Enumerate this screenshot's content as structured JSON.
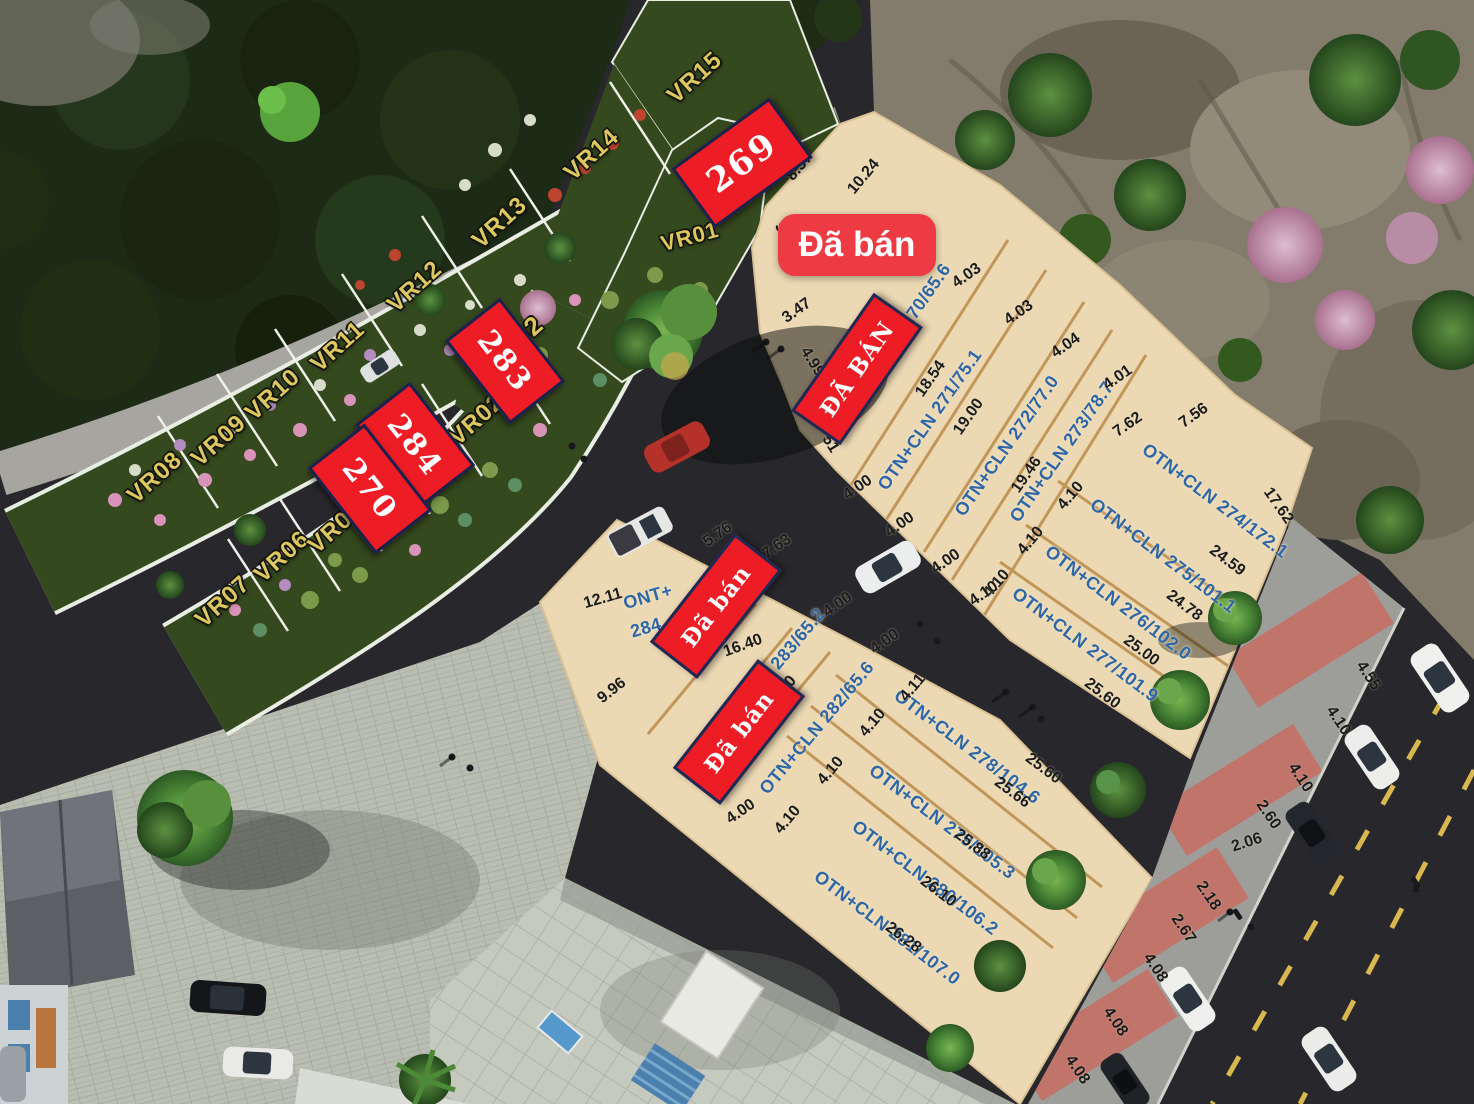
{
  "colors": {
    "plot_fill": "#ecd9b4",
    "plot_divider": "#c09659",
    "sold_red": "#ed1c25",
    "badge_red": "#ee3a43",
    "label_blue": "#2e66a6",
    "dim_black": "#1b1b1b",
    "vr_yellow": "#ddc75f",
    "garden_green": "#35491f",
    "road_asphalt": "#28282c"
  },
  "sold_overlays": [
    {
      "kind": "badge",
      "text": "Đã bán",
      "x": 857,
      "y": 245,
      "w": 158,
      "h": 62,
      "rot": 0
    },
    {
      "kind": "plate",
      "text": "ĐÃ BÁN",
      "x": 857,
      "y": 369,
      "w": 138,
      "h": 54,
      "rot": -55
    },
    {
      "kind": "plate",
      "text": "Đã bán",
      "x": 716,
      "y": 606,
      "w": 132,
      "h": 54,
      "rot": -52
    },
    {
      "kind": "plate",
      "text": "Đã bán",
      "x": 739,
      "y": 732,
      "w": 132,
      "h": 54,
      "rot": -52
    }
  ],
  "lot_number_overlays": [
    {
      "text": "269",
      "x": 742,
      "y": 163,
      "w": 115,
      "h": 68,
      "rot": -36,
      "size": 34
    },
    {
      "text": "283",
      "x": 505,
      "y": 361,
      "w": 100,
      "h": 64,
      "rot": 52,
      "size": 30
    },
    {
      "text": "284",
      "x": 415,
      "y": 445,
      "w": 100,
      "h": 64,
      "rot": 52,
      "size": 30
    },
    {
      "text": "270",
      "x": 370,
      "y": 489,
      "w": 104,
      "h": 66,
      "rot": 52,
      "size": 30
    }
  ],
  "vr_labels": [
    {
      "text": "VR15",
      "x": 695,
      "y": 78,
      "rot": -42
    },
    {
      "text": "VR14",
      "x": 592,
      "y": 155,
      "rot": -42
    },
    {
      "text": "VR13",
      "x": 500,
      "y": 223,
      "rot": -42
    },
    {
      "text": "VR12",
      "x": 415,
      "y": 287,
      "rot": -42
    },
    {
      "text": "VR11",
      "x": 338,
      "y": 347,
      "rot": -42
    },
    {
      "text": "VR10",
      "x": 273,
      "y": 395,
      "rot": -42
    },
    {
      "text": "VR09",
      "x": 219,
      "y": 441,
      "rot": -42
    },
    {
      "text": "VR08",
      "x": 155,
      "y": 478,
      "rot": -42
    },
    {
      "text": "VR07",
      "x": 223,
      "y": 602,
      "rot": -42
    },
    {
      "text": "VR06",
      "x": 282,
      "y": 557,
      "rot": -42
    },
    {
      "text": "VR05",
      "x": 336,
      "y": 528,
      "rot": -42
    },
    {
      "text": "VR02",
      "x": 477,
      "y": 420,
      "rot": -42
    },
    {
      "text": "02",
      "x": 528,
      "y": 331,
      "rot": -42,
      "size": 26
    },
    {
      "text": "VR01",
      "x": 690,
      "y": 237,
      "rot": -15,
      "size": 22
    }
  ],
  "plot_labels": [
    {
      "text": "OTN+CLN 270/65.6",
      "x": 899,
      "y": 334,
      "rot": -55
    },
    {
      "text": "OTN+CLN 271/75.1",
      "x": 930,
      "y": 420,
      "rot": -55
    },
    {
      "text": "OTN+CLN 272/77.0",
      "x": 1007,
      "y": 446,
      "rot": -55
    },
    {
      "text": "OTN+CLN 273/78.7",
      "x": 1062,
      "y": 452,
      "rot": -55
    },
    {
      "text": "OTN+CLN 274/172.1",
      "x": 1215,
      "y": 501,
      "rot": 37
    },
    {
      "text": "OTN+CLN 275/101.1",
      "x": 1163,
      "y": 556,
      "rot": 37
    },
    {
      "text": "OTN+CLN 276/102.0",
      "x": 1118,
      "y": 603,
      "rot": 37
    },
    {
      "text": "OTN+CLN 277/101.9",
      "x": 1085,
      "y": 645,
      "rot": 37
    },
    {
      "text": "ONT+",
      "x": 648,
      "y": 597,
      "rot": -16
    },
    {
      "text": "284",
      "x": 646,
      "y": 628,
      "rot": -16
    },
    {
      "text": "283/65.2",
      "x": 798,
      "y": 639,
      "rot": -50
    },
    {
      "text": "OTN+CLN 282/65.6",
      "x": 817,
      "y": 728,
      "rot": -50
    },
    {
      "text": "OTN+CLN 278/104.6",
      "x": 967,
      "y": 747,
      "rot": 37
    },
    {
      "text": "OTN+CLN 279/105.3",
      "x": 942,
      "y": 822,
      "rot": 37
    },
    {
      "text": "OTN+CLN 280/106.2",
      "x": 925,
      "y": 878,
      "rot": 37
    },
    {
      "text": "OTN+CLN 281/107.0",
      "x": 887,
      "y": 928,
      "rot": 37
    }
  ],
  "dimensions": [
    {
      "text": "8.37",
      "x": 800,
      "y": 167,
      "rot": -50
    },
    {
      "text": "10.24",
      "x": 864,
      "y": 177,
      "rot": -50
    },
    {
      "text": "5.14",
      "x": 786,
      "y": 237,
      "rot": 58
    },
    {
      "text": "3.47",
      "x": 797,
      "y": 311,
      "rot": -35
    },
    {
      "text": "14.29",
      "x": 879,
      "y": 330,
      "rot": -52
    },
    {
      "text": "4.99",
      "x": 812,
      "y": 362,
      "rot": 58
    },
    {
      "text": "51",
      "x": 830,
      "y": 444,
      "rot": 58
    },
    {
      "text": "18.54",
      "x": 931,
      "y": 379,
      "rot": -55
    },
    {
      "text": "19.00",
      "x": 969,
      "y": 417,
      "rot": -55
    },
    {
      "text": "19.46",
      "x": 1027,
      "y": 475,
      "rot": -55
    },
    {
      "text": "4.03",
      "x": 967,
      "y": 276,
      "rot": -35
    },
    {
      "text": "4.03",
      "x": 1019,
      "y": 313,
      "rot": -35
    },
    {
      "text": "4.04",
      "x": 1066,
      "y": 346,
      "rot": -35
    },
    {
      "text": "4.01",
      "x": 1118,
      "y": 378,
      "rot": -35
    },
    {
      "text": "7.62",
      "x": 1128,
      "y": 425,
      "rot": -35
    },
    {
      "text": "7.56",
      "x": 1194,
      "y": 416,
      "rot": -35
    },
    {
      "text": "17.62",
      "x": 1278,
      "y": 506,
      "rot": 55
    },
    {
      "text": "24.59",
      "x": 1227,
      "y": 561,
      "rot": 37
    },
    {
      "text": "24.78",
      "x": 1184,
      "y": 606,
      "rot": 37
    },
    {
      "text": "25.00",
      "x": 1141,
      "y": 651,
      "rot": 37
    },
    {
      "text": "25.60",
      "x": 1102,
      "y": 694,
      "rot": 37
    },
    {
      "text": "4.10",
      "x": 1071,
      "y": 496,
      "rot": -50
    },
    {
      "text": "4.10",
      "x": 1031,
      "y": 541,
      "rot": -50
    },
    {
      "text": "4.10",
      "x": 997,
      "y": 584,
      "rot": -50
    },
    {
      "text": "4.00",
      "x": 858,
      "y": 488,
      "rot": -35
    },
    {
      "text": "4.00",
      "x": 900,
      "y": 525,
      "rot": -35
    },
    {
      "text": "4.00",
      "x": 946,
      "y": 562,
      "rot": -35
    },
    {
      "text": "4.10",
      "x": 984,
      "y": 594,
      "rot": -35
    },
    {
      "text": "4.55",
      "x": 1368,
      "y": 676,
      "rot": 56
    },
    {
      "text": "4.10",
      "x": 1338,
      "y": 721,
      "rot": 56
    },
    {
      "text": "4.10",
      "x": 1300,
      "y": 778,
      "rot": 56
    },
    {
      "text": "2.60",
      "x": 1268,
      "y": 815,
      "rot": 56
    },
    {
      "text": "2.06",
      "x": 1247,
      "y": 843,
      "rot": -18
    },
    {
      "text": "2.18",
      "x": 1208,
      "y": 896,
      "rot": 56
    },
    {
      "text": "2.67",
      "x": 1183,
      "y": 929,
      "rot": 56
    },
    {
      "text": "4.08",
      "x": 1155,
      "y": 968,
      "rot": 56
    },
    {
      "text": "4.08",
      "x": 1115,
      "y": 1022,
      "rot": 56
    },
    {
      "text": "4.08",
      "x": 1077,
      "y": 1070,
      "rot": 56
    },
    {
      "text": "12.11",
      "x": 603,
      "y": 599,
      "rot": -16
    },
    {
      "text": "5.76",
      "x": 718,
      "y": 535,
      "rot": -35
    },
    {
      "text": "7.63",
      "x": 777,
      "y": 547,
      "rot": -35
    },
    {
      "text": "9.96",
      "x": 612,
      "y": 691,
      "rot": -38
    },
    {
      "text": "16.40",
      "x": 743,
      "y": 646,
      "rot": -20
    },
    {
      "text": "40",
      "x": 788,
      "y": 685,
      "rot": -50
    },
    {
      "text": "4.00",
      "x": 838,
      "y": 605,
      "rot": -35
    },
    {
      "text": "4.00",
      "x": 885,
      "y": 642,
      "rot": -35
    },
    {
      "text": "4.11",
      "x": 913,
      "y": 688,
      "rot": -50
    },
    {
      "text": "4.10",
      "x": 873,
      "y": 723,
      "rot": -50
    },
    {
      "text": "4.10",
      "x": 831,
      "y": 771,
      "rot": -50
    },
    {
      "text": "4.10",
      "x": 788,
      "y": 820,
      "rot": -50
    },
    {
      "text": "4.00",
      "x": 741,
      "y": 812,
      "rot": -35
    },
    {
      "text": "25.60",
      "x": 1043,
      "y": 769,
      "rot": 37
    },
    {
      "text": "25.66",
      "x": 1012,
      "y": 793,
      "rot": 37
    },
    {
      "text": "25.88",
      "x": 972,
      "y": 845,
      "rot": 37
    },
    {
      "text": "26.10",
      "x": 938,
      "y": 892,
      "rot": 37
    },
    {
      "text": "26.28",
      "x": 903,
      "y": 938,
      "rot": 37
    }
  ]
}
